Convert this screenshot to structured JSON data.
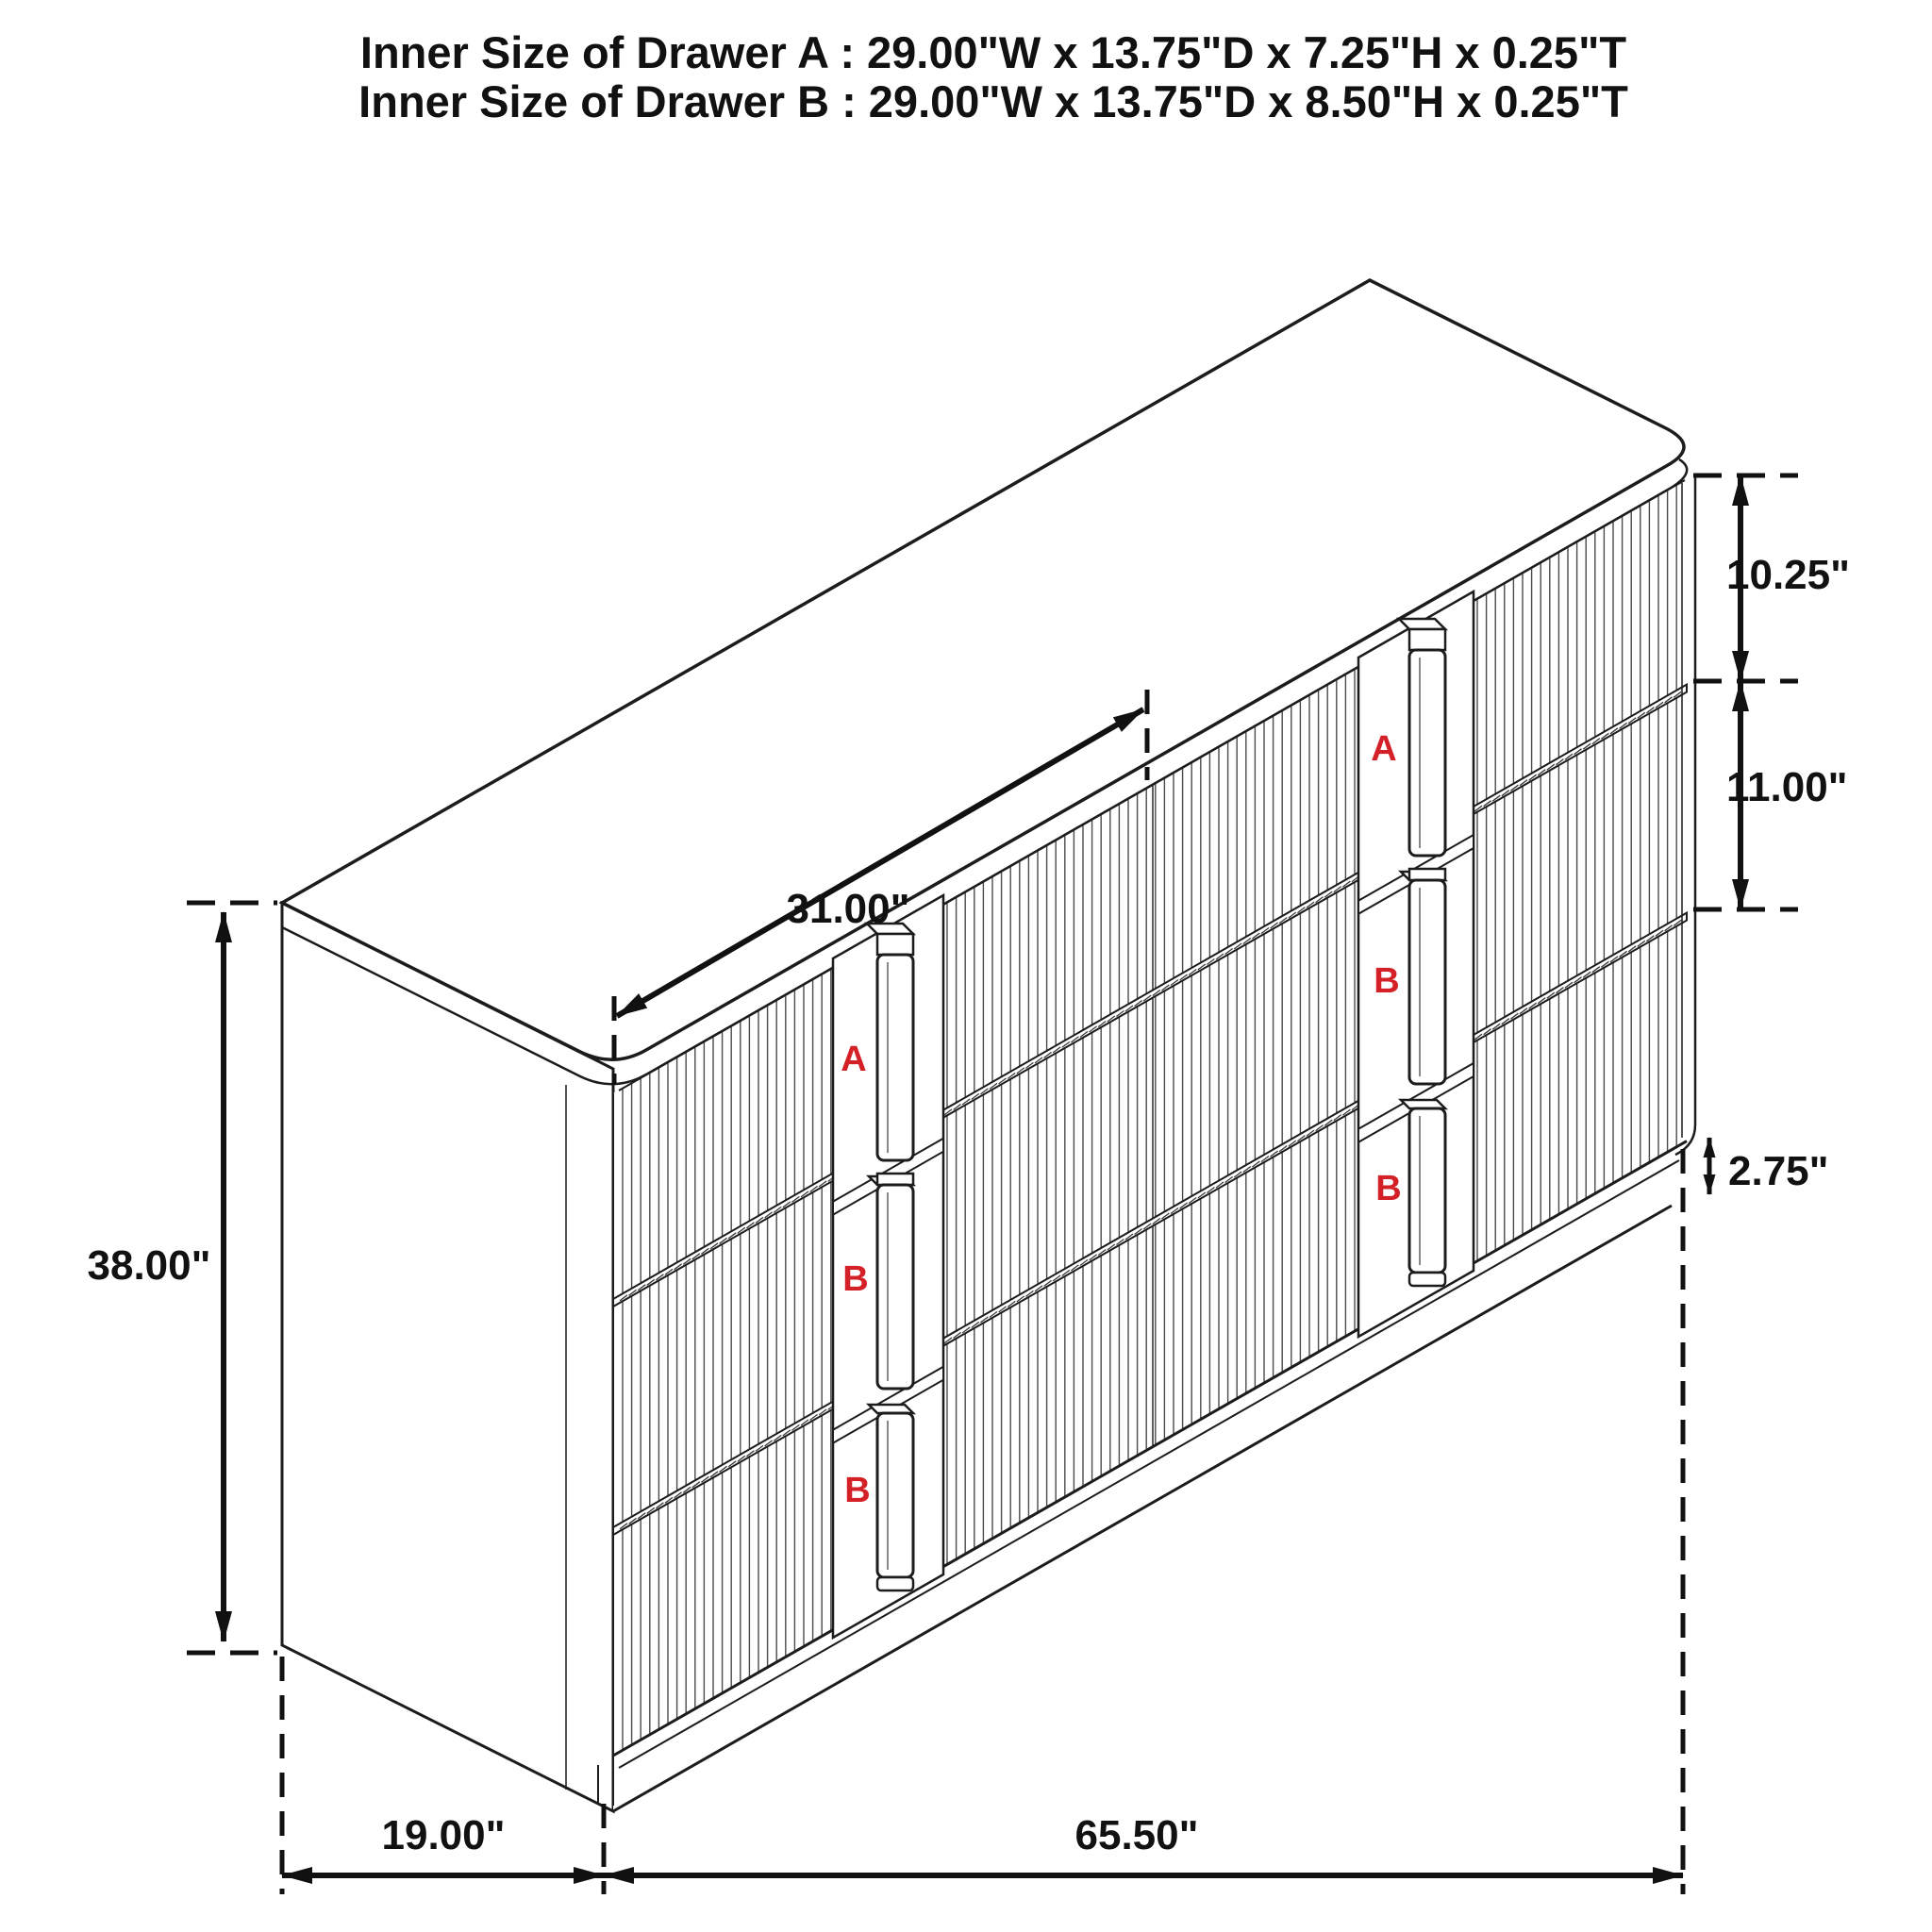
{
  "title": {
    "line_a": "Inner Size of Drawer A : 29.00\"W x 13.75\"D x 7.25\"H x 0.25\"T",
    "line_b": "Inner Size of Drawer B : 29.00\"W x 13.75\"D x 8.50\"H x 0.25\"T"
  },
  "dimensions": {
    "drawer_front_width": "31.00\"",
    "overall_height": "38.00\"",
    "overall_depth": "19.00\"",
    "overall_width": "65.50\"",
    "drawer_a_front_height": "10.25\"",
    "drawer_b_front_height": "11.00\"",
    "base_height": "2.75\""
  },
  "drawer_labels": {
    "left_column": [
      "A",
      "B",
      "B"
    ],
    "right_column": [
      "A",
      "B",
      "B"
    ]
  },
  "colors": {
    "outline": "#1c1c1c",
    "flute": "#4b4b4b",
    "drawer_label": "#d42127",
    "background": "#ffffff"
  }
}
